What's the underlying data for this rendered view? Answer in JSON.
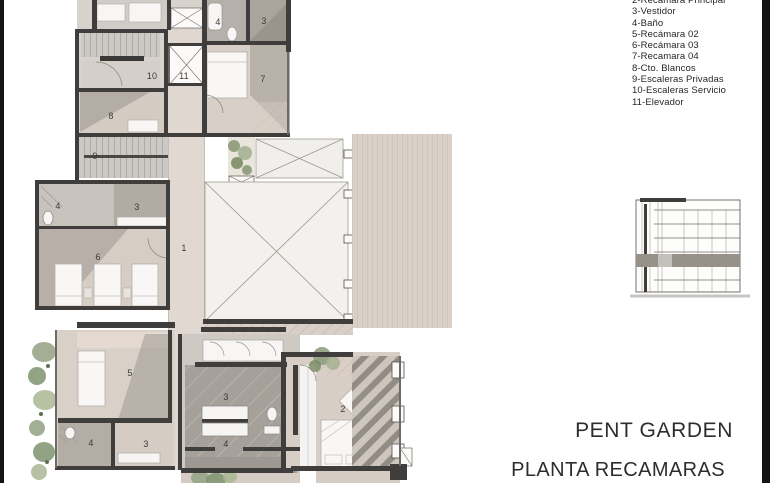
{
  "frame": {
    "bg": "#ffffff",
    "edge_bar_color": "#141414"
  },
  "legend": {
    "items": [
      "2-Recámara Principal",
      "3-Vestidor",
      "4-Baño",
      "5-Recámara 02",
      "6-Recámara 03",
      "7-Recamara 04",
      "8-Cto. Blancos",
      "9-Escaleras Privadas",
      "10-Escaleras Servicio",
      "11-Elevador"
    ]
  },
  "titles": {
    "project": "PENT GARDEN",
    "plan": "PLANTA RECAMARAS"
  },
  "floor_plan": {
    "room_labels": [
      {
        "n": "4",
        "x": 218,
        "y": 22
      },
      {
        "n": "3",
        "x": 264,
        "y": 21
      },
      {
        "n": "10",
        "x": 152,
        "y": 76
      },
      {
        "n": "11",
        "x": 184,
        "y": 76
      },
      {
        "n": "7",
        "x": 263,
        "y": 79
      },
      {
        "n": "8",
        "x": 111,
        "y": 116
      },
      {
        "n": "9",
        "x": 95,
        "y": 156
      },
      {
        "n": "4",
        "x": 58,
        "y": 206
      },
      {
        "n": "3",
        "x": 137,
        "y": 207
      },
      {
        "n": "1",
        "x": 184,
        "y": 248
      },
      {
        "n": "6",
        "x": 98,
        "y": 257
      },
      {
        "n": "5",
        "x": 130,
        "y": 373
      },
      {
        "n": "3",
        "x": 226,
        "y": 397
      },
      {
        "n": "2",
        "x": 343,
        "y": 409
      },
      {
        "n": "4",
        "x": 91,
        "y": 443
      },
      {
        "n": "3",
        "x": 146,
        "y": 444
      },
      {
        "n": "4",
        "x": 226,
        "y": 444
      }
    ]
  },
  "colors": {
    "wall": "#403e3c",
    "floor_beige": "#d9d0c7",
    "floor_gray": "#a8a29b",
    "void_white": "#f3f1ed",
    "greenery": "#8fa07e",
    "text": "#2d2d2d"
  }
}
